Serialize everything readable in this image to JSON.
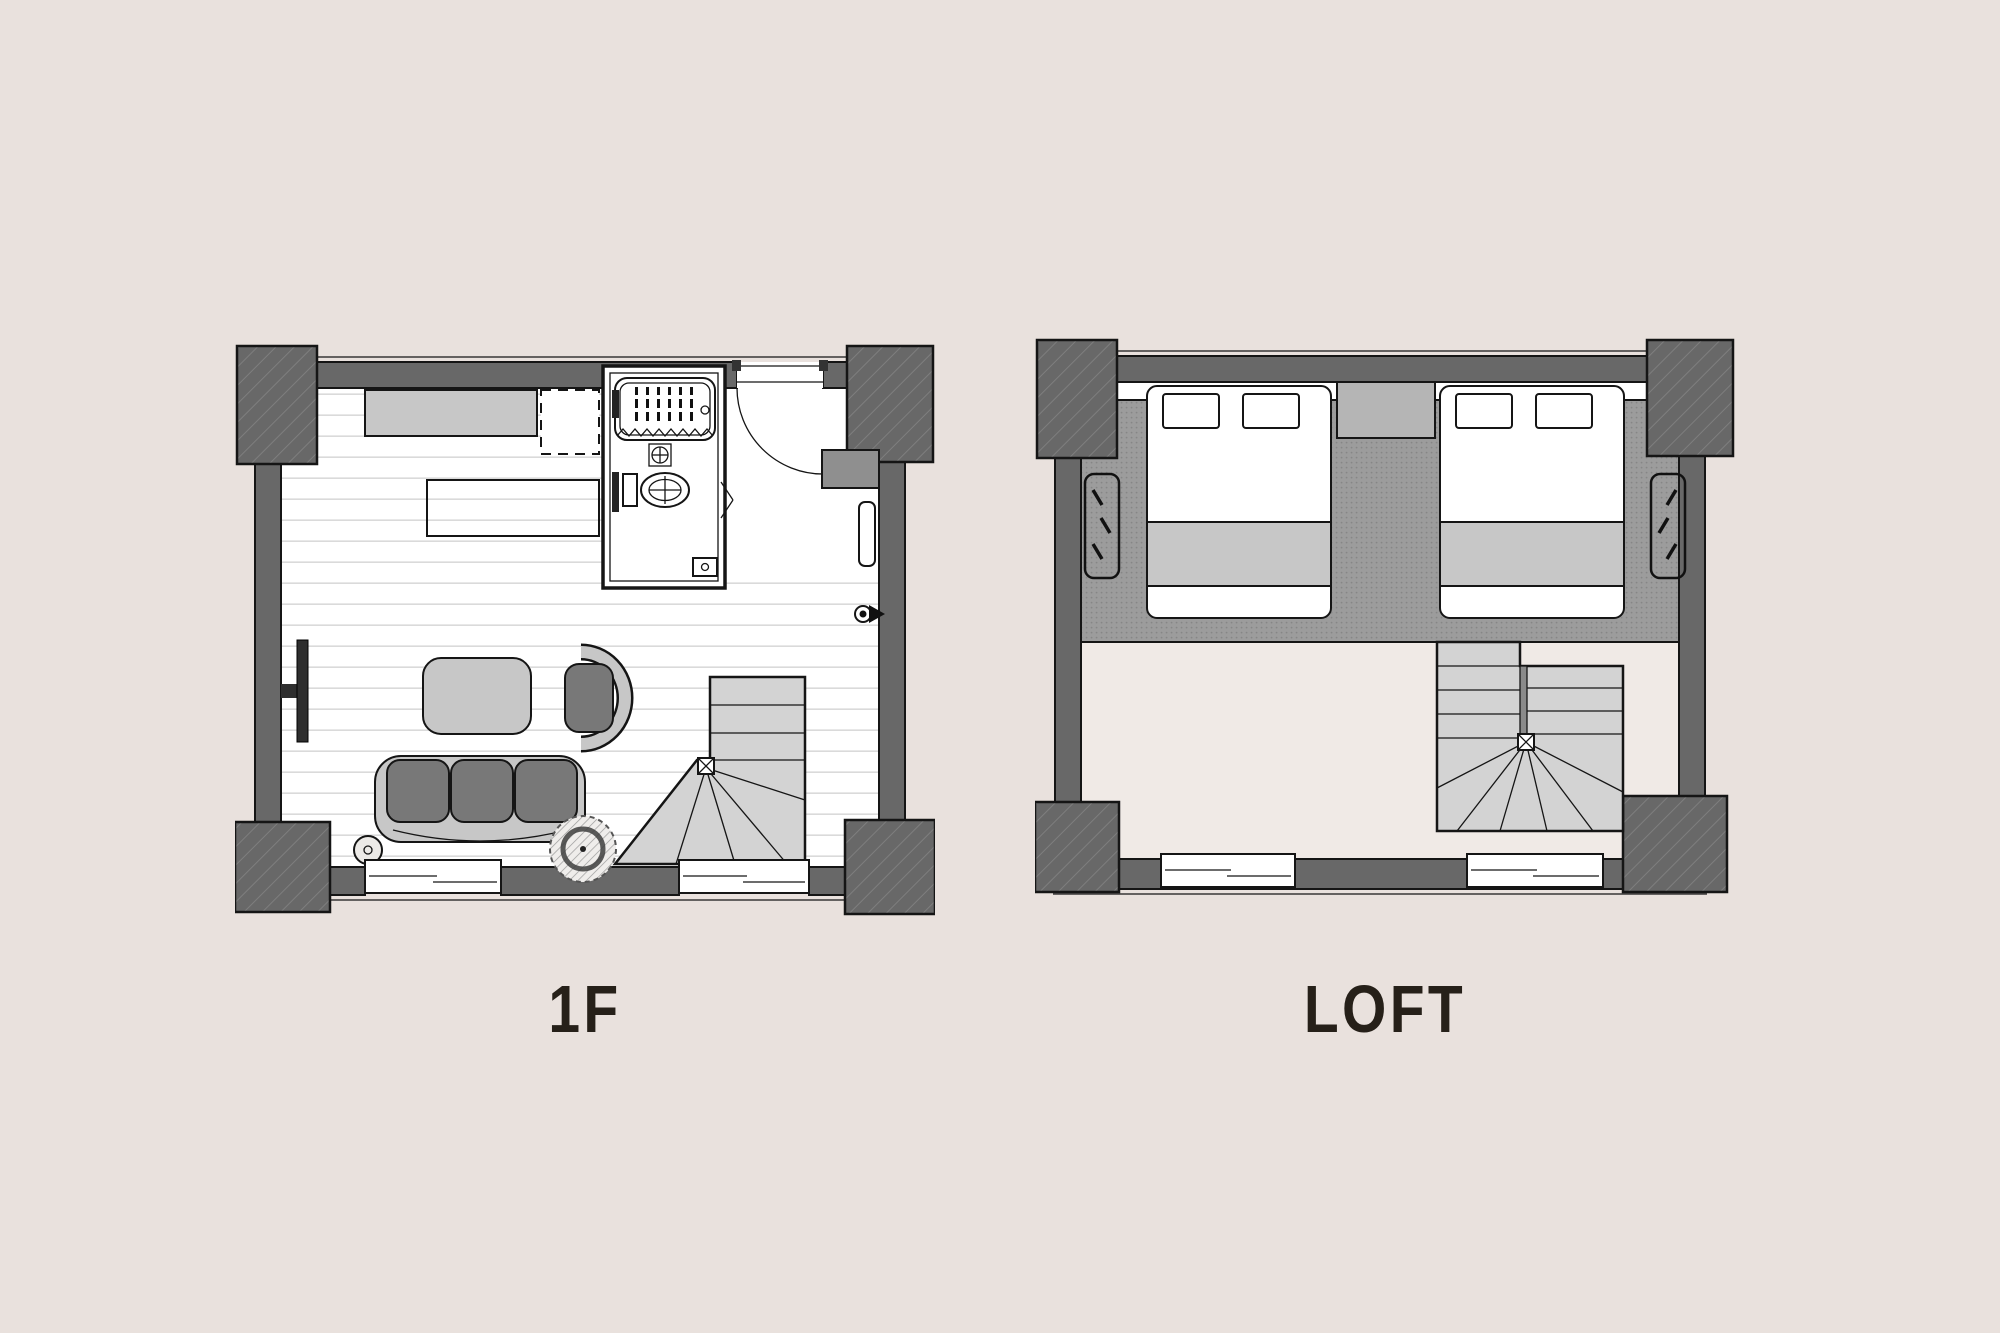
{
  "page": {
    "background_color": "#e9e1dd",
    "text_color": "#262019",
    "type": "architectural-floor-plan"
  },
  "plans": [
    {
      "id": "plan-1f",
      "label": "1F",
      "fixtures": [
        "kitchen-counter",
        "refrigerator-space",
        "dining-table",
        "unit-bathroom",
        "bathtub",
        "shower-mixer",
        "toilet",
        "washbasin",
        "entrance-door",
        "entrance-step",
        "shoe-cabinet",
        "door-handle",
        "wall-tv",
        "coffee-table",
        "armchair",
        "three-seat-sofa",
        "side-table",
        "potted-plant",
        "winder-staircase",
        "window-left",
        "window-right"
      ]
    },
    {
      "id": "plan-loft",
      "label": "LOFT",
      "fixtures": [
        "bed-left",
        "bed-right",
        "pillows",
        "nightstand",
        "carpet-mat",
        "side-window-left",
        "side-window-right",
        "open-void",
        "winder-staircase",
        "window-left",
        "window-right"
      ]
    }
  ],
  "colors": {
    "background": "#e9e1dd",
    "text": "#262019",
    "wall": "#686868",
    "outline": "#151515",
    "floor": "#ffffff",
    "plank-line": "#dadada",
    "furniture-light": "#c7c7c7",
    "furniture-mid": "#b5b5b5",
    "furniture-dark": "#787878",
    "stair-tread": "#d3d3d3",
    "mat": "#9c9c9c",
    "mat-dot": "#868686",
    "void": "#f0eae6",
    "step": "#8f8f8f",
    "tv": "#2e2e2e"
  }
}
